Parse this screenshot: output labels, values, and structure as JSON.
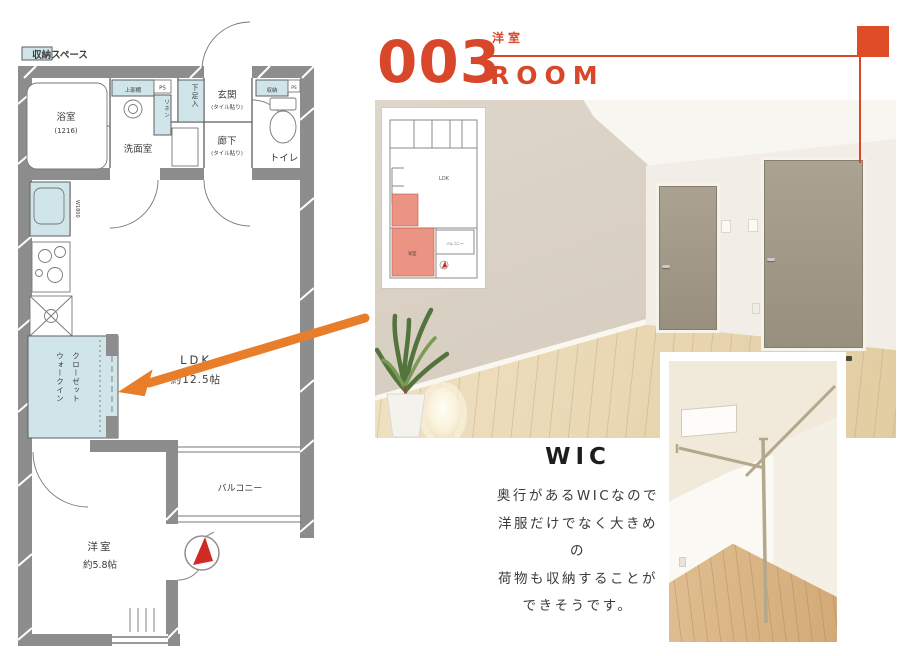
{
  "colors": {
    "accent": "#d9472b",
    "accent_square": "#e04b28",
    "arrow_orange": "#e87d2a",
    "storage_blue": "#cfe5ea",
    "wall_gray": "#8d8d8d",
    "highlight_salmon": "#ea8f7d"
  },
  "legend": {
    "storage_label": "収納スペース"
  },
  "header": {
    "number": "003",
    "subtitle": "洋室",
    "title": "ROOM"
  },
  "floorplan": {
    "bath_label": "浴室",
    "bath_size": "(1216)",
    "washroom_label": "洗面室",
    "upper_shelf_label": "上部棚",
    "ps_label": "PS",
    "linen_label": "リネン",
    "shoe_label": "下足入",
    "entrance_label": "玄関",
    "tile_note": "(タイル貼り)",
    "storage_label": "収納",
    "toilet_label": "トイレ",
    "hallway_label": "廊下",
    "kitchen_note": "W1800",
    "ldk_label": "LDK",
    "ldk_size": "約12.5帖",
    "wic_label_1": "ウォークイン",
    "wic_label_2": "クローゼット",
    "western_label": "洋室",
    "western_size": "約5.8帖",
    "balcony_label": "バルコニー"
  },
  "thumbnail": {
    "ldk": "LDK",
    "balcony": "バルコニー",
    "western": "洋室"
  },
  "wic_section": {
    "title": "WIC",
    "line1": "奥行があるWICなので",
    "line2": "洋服だけでなく大きめの",
    "line3": "荷物も収納することが",
    "line4": "できそうです。"
  }
}
